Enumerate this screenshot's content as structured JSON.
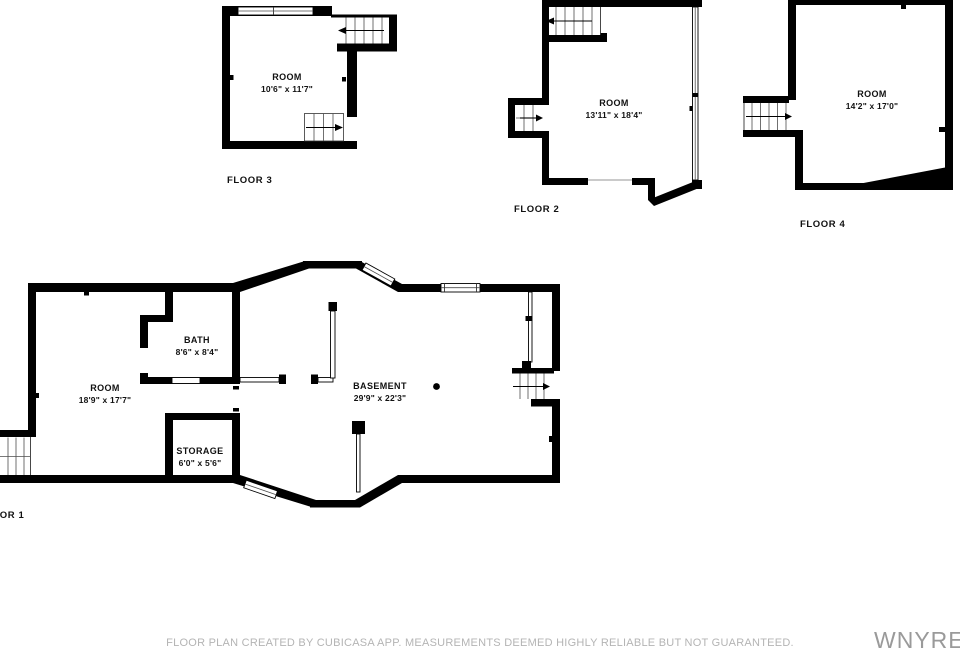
{
  "colors": {
    "wall": "#000000",
    "stair_line": "#4d4d4d",
    "label_text": "#111111",
    "disclaimer_text": "#b4b4b4",
    "watermark_text": "#9a9a9a"
  },
  "floors": {
    "floor1": {
      "name": "FLOOR 1",
      "room": {
        "label": "ROOM",
        "dims": "18'9\" x 17'7\""
      },
      "bath": {
        "label": "BATH",
        "dims": "8'6\" x 8'4\""
      },
      "storage": {
        "label": "STORAGE",
        "dims": "6'0\" x 5'6\""
      },
      "basement": {
        "label": "BASEMENT",
        "dims": "29'9\" x 22'3\""
      }
    },
    "floor2": {
      "name": "FLOOR 2",
      "room": {
        "label": "ROOM",
        "dims": "13'11\" x 18'4\""
      }
    },
    "floor3": {
      "name": "FLOOR 3",
      "room": {
        "label": "ROOM",
        "dims": "10'6\" x 11'7\""
      }
    },
    "floor4": {
      "name": "FLOOR 4",
      "room": {
        "label": "ROOM",
        "dims": "14'2\" x 17'0\""
      }
    }
  },
  "footer": {
    "disclaimer": "FLOOR PLAN CREATED BY CUBICASA APP. MEASUREMENTS DEEMED HIGHLY RELIABLE BUT NOT GUARANTEED."
  },
  "watermark": {
    "text": "WNYREI"
  }
}
